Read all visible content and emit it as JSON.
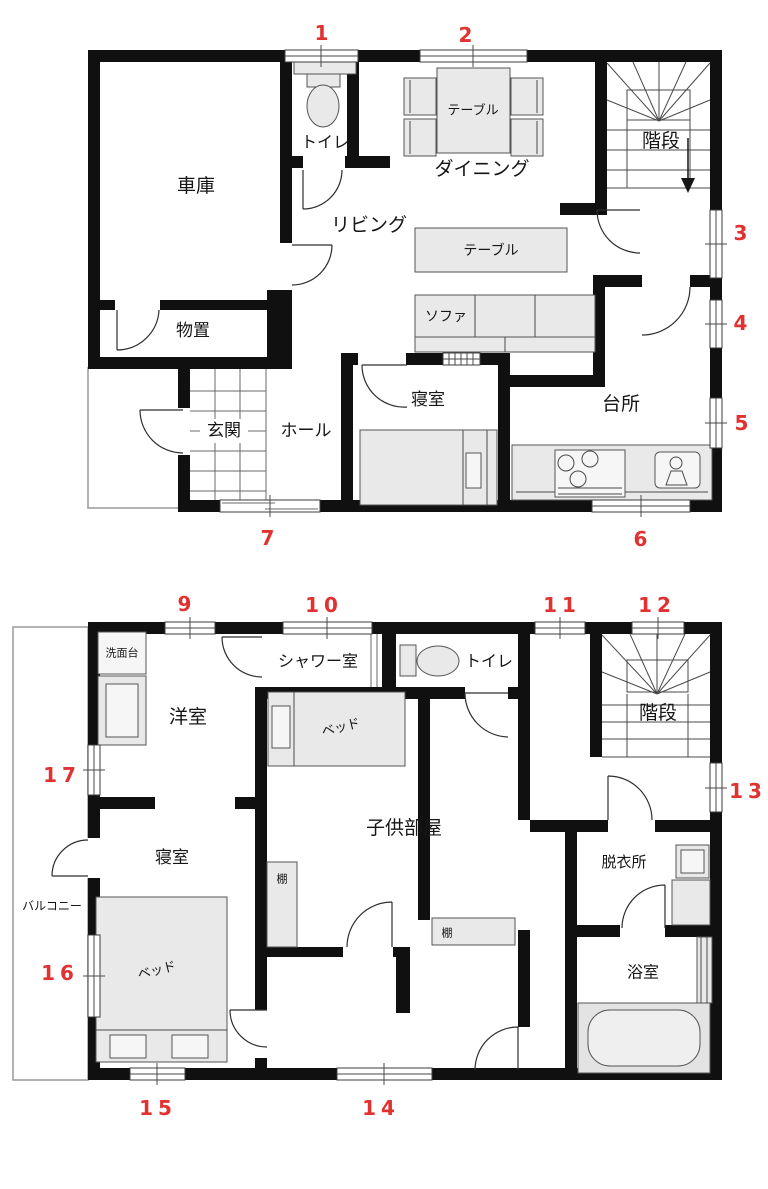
{
  "palette": {
    "wall": "#101010",
    "line": "#444444",
    "furniture_fill": "#e9e9e9",
    "accent_red": "#e03230",
    "thin_gray": "#9a9a9a"
  },
  "floor1": {
    "rooms": {
      "garage": "車庫",
      "toilet": "トイレ",
      "living": "リビング",
      "dining": "ダイニング",
      "stairs": "階段",
      "storage": "物置",
      "entrance": "玄関",
      "hall": "ホール",
      "bedroom": "寝室",
      "kitchen": "台所"
    },
    "furniture": {
      "dining_table": "テーブル",
      "living_table": "テーブル",
      "sofa": "ソファ"
    },
    "window_labels": [
      "1",
      "2",
      "3",
      "4",
      "5",
      "6",
      "7"
    ]
  },
  "floor2": {
    "rooms": {
      "washstand": "洗面台",
      "western_room": "洋室",
      "shower_room": "シャワー室",
      "toilet": "トイレ",
      "stairs": "階段",
      "bedroom": "寝室",
      "kids_room": "子供部屋",
      "dressing_room": "脱衣所",
      "bathroom": "浴室",
      "balcony": "バルコニー"
    },
    "furniture": {
      "bed_kids": "ベッド",
      "bed_master": "ベッド",
      "shelf_1": "棚",
      "shelf_2": "棚"
    },
    "window_labels": [
      "9",
      "10",
      "11",
      "12",
      "13",
      "14",
      "15",
      "16",
      "17"
    ]
  }
}
